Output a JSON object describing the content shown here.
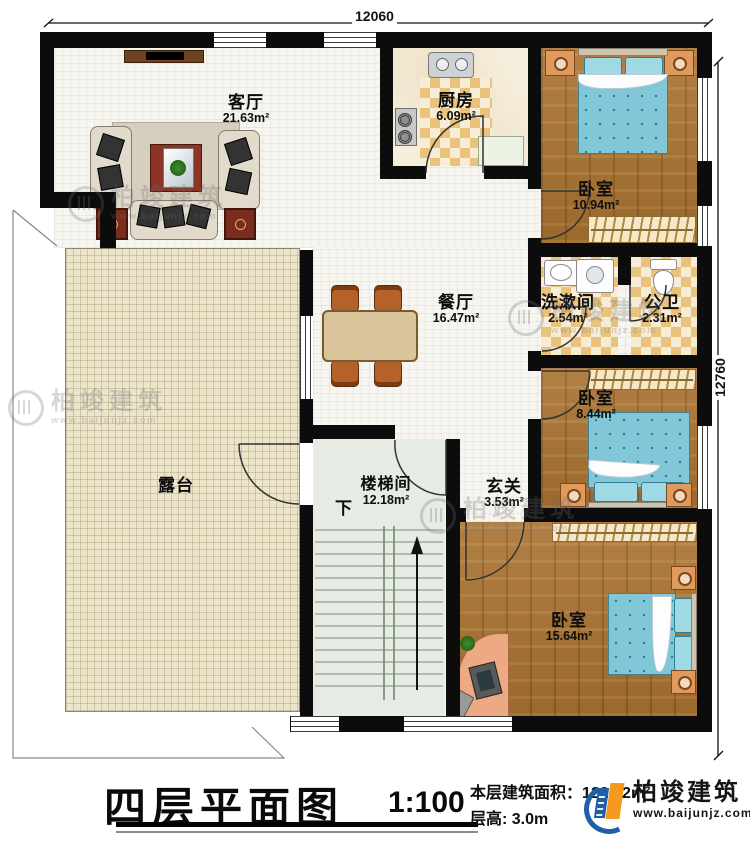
{
  "dimensions": {
    "top": "12060",
    "right": "12760"
  },
  "rooms": {
    "living": {
      "name": "客厅",
      "area": "21.63m²"
    },
    "kitchen": {
      "name": "厨房",
      "area": "6.09m²"
    },
    "bedroom1": {
      "name": "卧室",
      "area": "10.94m²"
    },
    "dining": {
      "name": "餐厅",
      "area": "16.47m²"
    },
    "washroom": {
      "name": "洗漱间",
      "area": "2.54m²"
    },
    "toilet": {
      "name": "公卫",
      "area": "2.31m²"
    },
    "bedroom2": {
      "name": "卧室",
      "area": "8.44m²"
    },
    "terrace": {
      "name": "露台",
      "area": ""
    },
    "stairwell": {
      "name": "楼梯间",
      "area": "12.18m²"
    },
    "foyer": {
      "name": "玄关",
      "area": "3.53m²"
    },
    "bedroom3": {
      "name": "卧室",
      "area": "15.64m²"
    }
  },
  "stairs": {
    "direction_label": "下"
  },
  "titleblock": {
    "title": "四层平面图",
    "scale": "1:100",
    "area_line": "本层建筑面积：122.62m²",
    "height_line": "层高: 3.0m"
  },
  "brand": {
    "name": "柏竣建筑",
    "url": "www.baijunjz.com"
  },
  "colors": {
    "wall": "#0c0c0c",
    "wood": "#a9712f",
    "bed": "#82c7d8",
    "accent_blue": "#1e5fa8",
    "accent_orange": "#f49a1e"
  }
}
